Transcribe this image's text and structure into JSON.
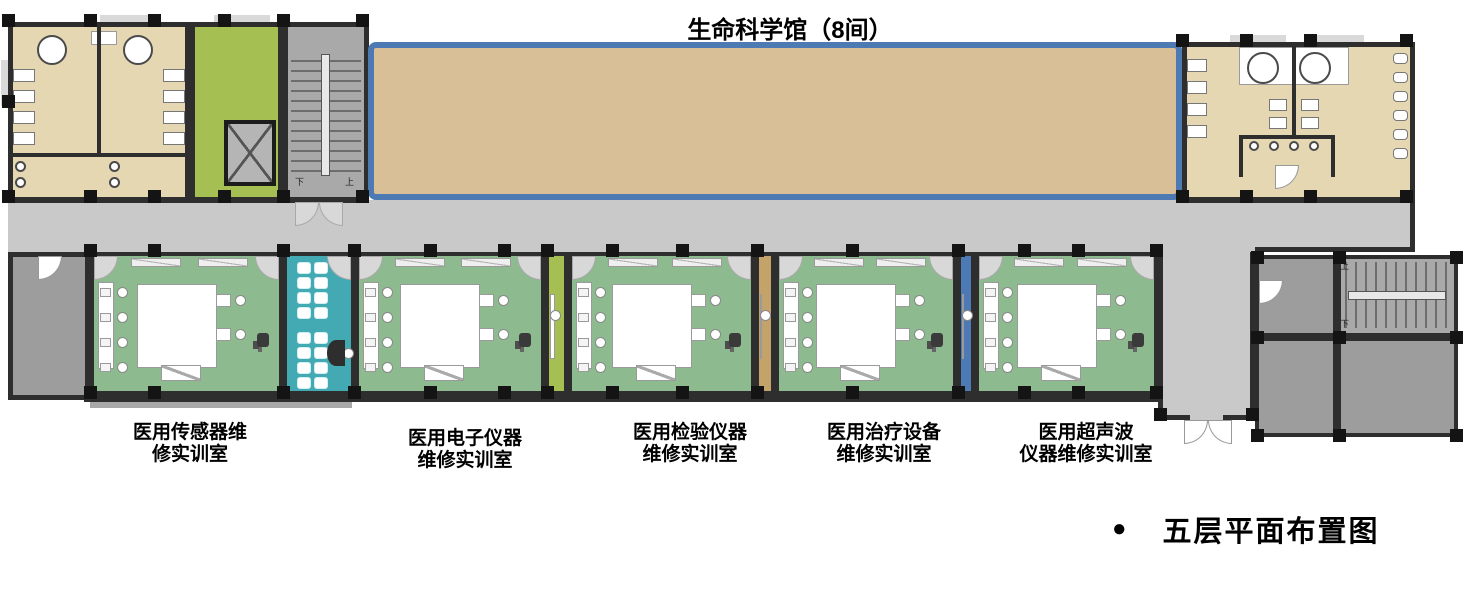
{
  "title": "生命科学馆（8间）",
  "caption": {
    "bullet": "●",
    "text": "五层平面布置图"
  },
  "stairs": {
    "down": "下",
    "up": "上"
  },
  "room_labels": [
    {
      "line1": "医用传感器维",
      "line2": "修实训室"
    },
    {
      "line1": "医用电子仪器",
      "line2": "维修实训室"
    },
    {
      "line1": "医用检验仪器",
      "line2": "维修实训室"
    },
    {
      "line1": "医用治疗设备",
      "line2": "维修实训室"
    },
    {
      "line1": "医用超声波",
      "line2": "仪器维修实训室"
    }
  ],
  "colors": {
    "wall": "#2e2e2e",
    "bath": "#e6d7b3",
    "hall": "#d9bf98",
    "hallborder": "#4d7ab2",
    "lime": "#a6bf52",
    "corridor": "#c9c9ca",
    "green": "#8eba90",
    "teal": "#43aab4",
    "tanstrip": "#c4a36a",
    "bluestrip": "#4d7ab5",
    "grayroom": "#9d9d9d",
    "stair": "#a9a9a9"
  }
}
